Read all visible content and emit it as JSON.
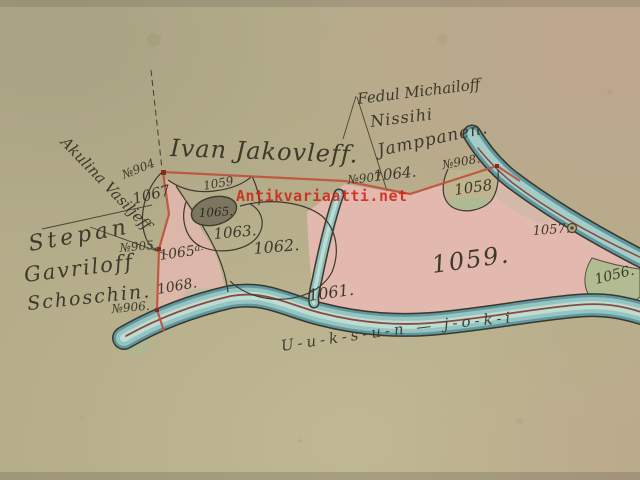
{
  "names": {
    "ivan": "Ivan Jakovleff.",
    "akulina": "Akulina Vasiljeff",
    "stepan1": "Stepan",
    "stepan2": "Gavriloff",
    "stepan3": "Schoschin.",
    "fedul": "Fedul Michailoff",
    "nissihi": "Nissihi",
    "jamppanen": "Jamppanen."
  },
  "survey_points": {
    "p904": "№904",
    "p905": "№905.",
    "p906": "№906.",
    "p907": "№907.",
    "p908": "№908."
  },
  "parcels": {
    "p1056": "1056.",
    "p1057": "1057.",
    "p1058": "1058",
    "p1059_small": "1059",
    "p1059_big": "1059.",
    "p1061": "1061.",
    "p1062": "1062.",
    "p1063": "1063.",
    "p1064": "1064.",
    "p1065": "1065.",
    "p1065a": "1065",
    "p1065a_sup": "a.",
    "p1067": "1067",
    "p1068": "1068."
  },
  "river_label": "U-u-k-s-u-n — j-o-k-i",
  "watermark": "Antikvariaatti.net",
  "colors": {
    "paper": "#b5ad8a",
    "ink": "#3d392b",
    "boundary_red": "#c0513c",
    "river_centerline_red": "#8c4a3e",
    "river_teal": "#96c5c0",
    "parcel_pink": "#e8b9b4",
    "cape_green": "#a9bd8f",
    "pond_dark": "#7c7660",
    "watermark_red": "#d01b0b"
  }
}
